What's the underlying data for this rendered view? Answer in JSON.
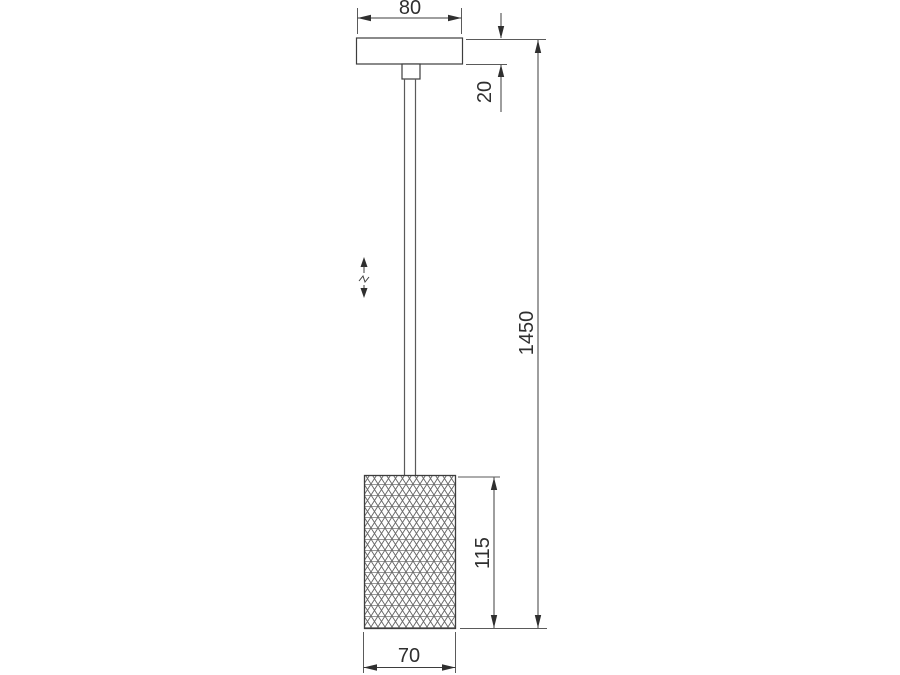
{
  "figure": {
    "colors": {
      "background": "#ffffff",
      "line": "#3d3d3d",
      "extension_line": "#5a5a5a",
      "pattern_diagonal": "#646464",
      "pattern_horizontal": "#979797",
      "text": "#2f2f2f"
    },
    "dimensions": {
      "canopy_width": "80",
      "canopy_height": "20",
      "overall_height": "1450",
      "shade_height": "115",
      "shade_width": "70"
    }
  }
}
